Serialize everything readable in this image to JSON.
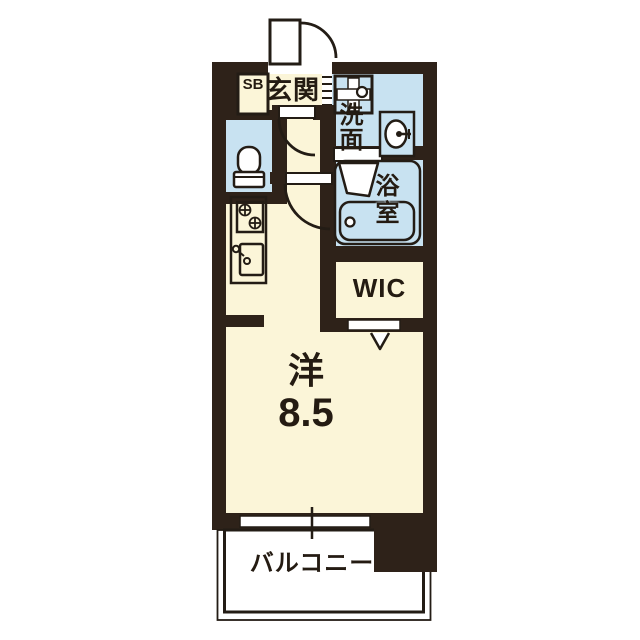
{
  "plan": {
    "title": "apartment-floor-plan",
    "labels": {
      "shoe_box": "SB",
      "entrance": "玄関",
      "washroom": "洗面",
      "bathroom": "浴室",
      "wic": "WIC",
      "main_room_type": "洋",
      "main_room_size": "8.5",
      "balcony": "バルコニー"
    },
    "colors": {
      "wall": "#2e2219",
      "room_floor": "#fbf5d8",
      "wet_area": "#c8e2f1",
      "fixture_line": "#231c15",
      "background": "#ffffff"
    },
    "fixture_icons": [
      "entrance-door-icon",
      "toilet-icon",
      "stove-burners-icon",
      "kitchen-sink-icon",
      "washing-machine-pan-icon",
      "wash-basin-icon",
      "bathtub-icon",
      "folding-bath-door-icon",
      "sliding-window-icon",
      "wic-folding-door-icon"
    ]
  }
}
